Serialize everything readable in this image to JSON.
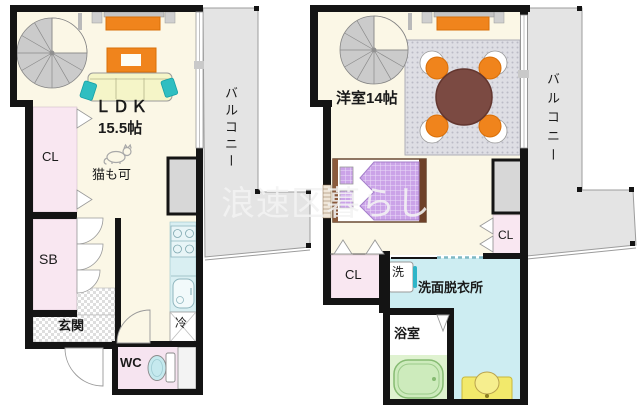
{
  "watermark_text": "浪速区暮らし",
  "left_unit": {
    "ldk_label": "ＬＤＫ",
    "ldk_size": "15.5帖",
    "pet_note": "猫も可",
    "closet_label": "CL",
    "shoebox_label": "SB",
    "entrance_label": "玄関",
    "toilet_label": "WC",
    "fridge_label": "冷",
    "balcony_label": "バルコニー"
  },
  "right_unit": {
    "room_label": "洋室14帖",
    "closet_left_label": "CL",
    "closet_right_label": "CL",
    "washer_label": "洗",
    "washroom_label": "洗面脱衣所",
    "bathroom_label": "浴室",
    "balcony_label": "バルコニー"
  },
  "colors": {
    "wall": "#141414",
    "floor_cream": "#FBF7E6",
    "closet_pink": "#F9E7F1",
    "water_blue": "#CDEDF2",
    "balcony_gray": "#E4E4E4",
    "furniture_orange": "#F0841C",
    "table_brown": "#7B4A42",
    "bed_purple": "#CBA3E8",
    "tub_green": "#CDEBBC",
    "vanity_yellow": "#F2E96B",
    "sofa_yellow": "#F5F5C8",
    "cushion_teal": "#2FBEC1"
  }
}
